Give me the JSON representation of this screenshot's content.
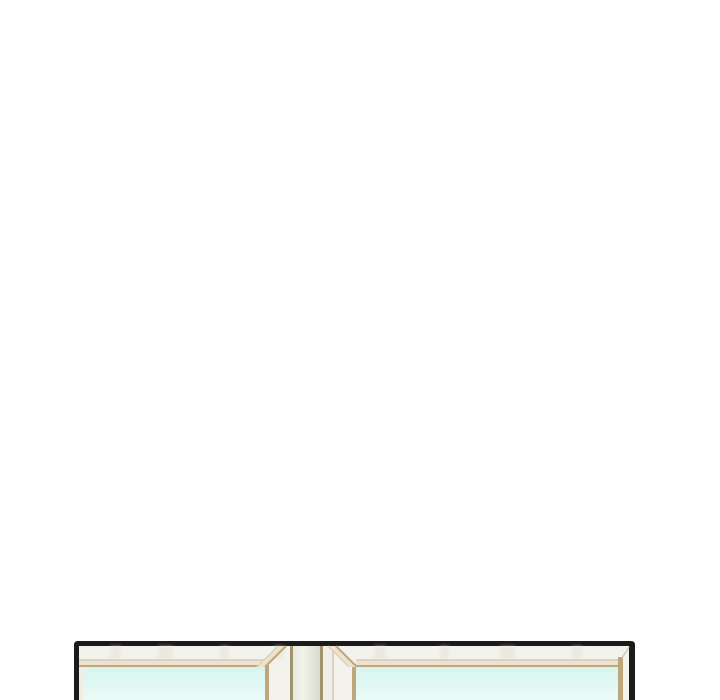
{
  "page": {
    "background": "#ffffff",
    "content_type": "comic-panel",
    "subject": "top edge of a two-pane window entering from the bottom of the page"
  },
  "illustration": {
    "colors": {
      "outline": "#1b1b1b",
      "frame": "#f4f2ec",
      "frame_streak": "#e4e2d6",
      "band_shadow": "#dbd2c0",
      "band_cream": "#ece2cd",
      "band_tan": "#bea77d",
      "left_strip": "#f2ede1",
      "post_tan": "#a2946c",
      "post_side": "#f0efe7",
      "post_edge": "#d8d3c3",
      "seam": "#cfc8b4",
      "glass_top": "#d8f4ee",
      "glass_bottom": "#eafbf7",
      "post_grad_left": "#e7eadf",
      "post_grad_mid": "#f1f2ea",
      "post_grad_right": "#d6dbcd"
    }
  }
}
